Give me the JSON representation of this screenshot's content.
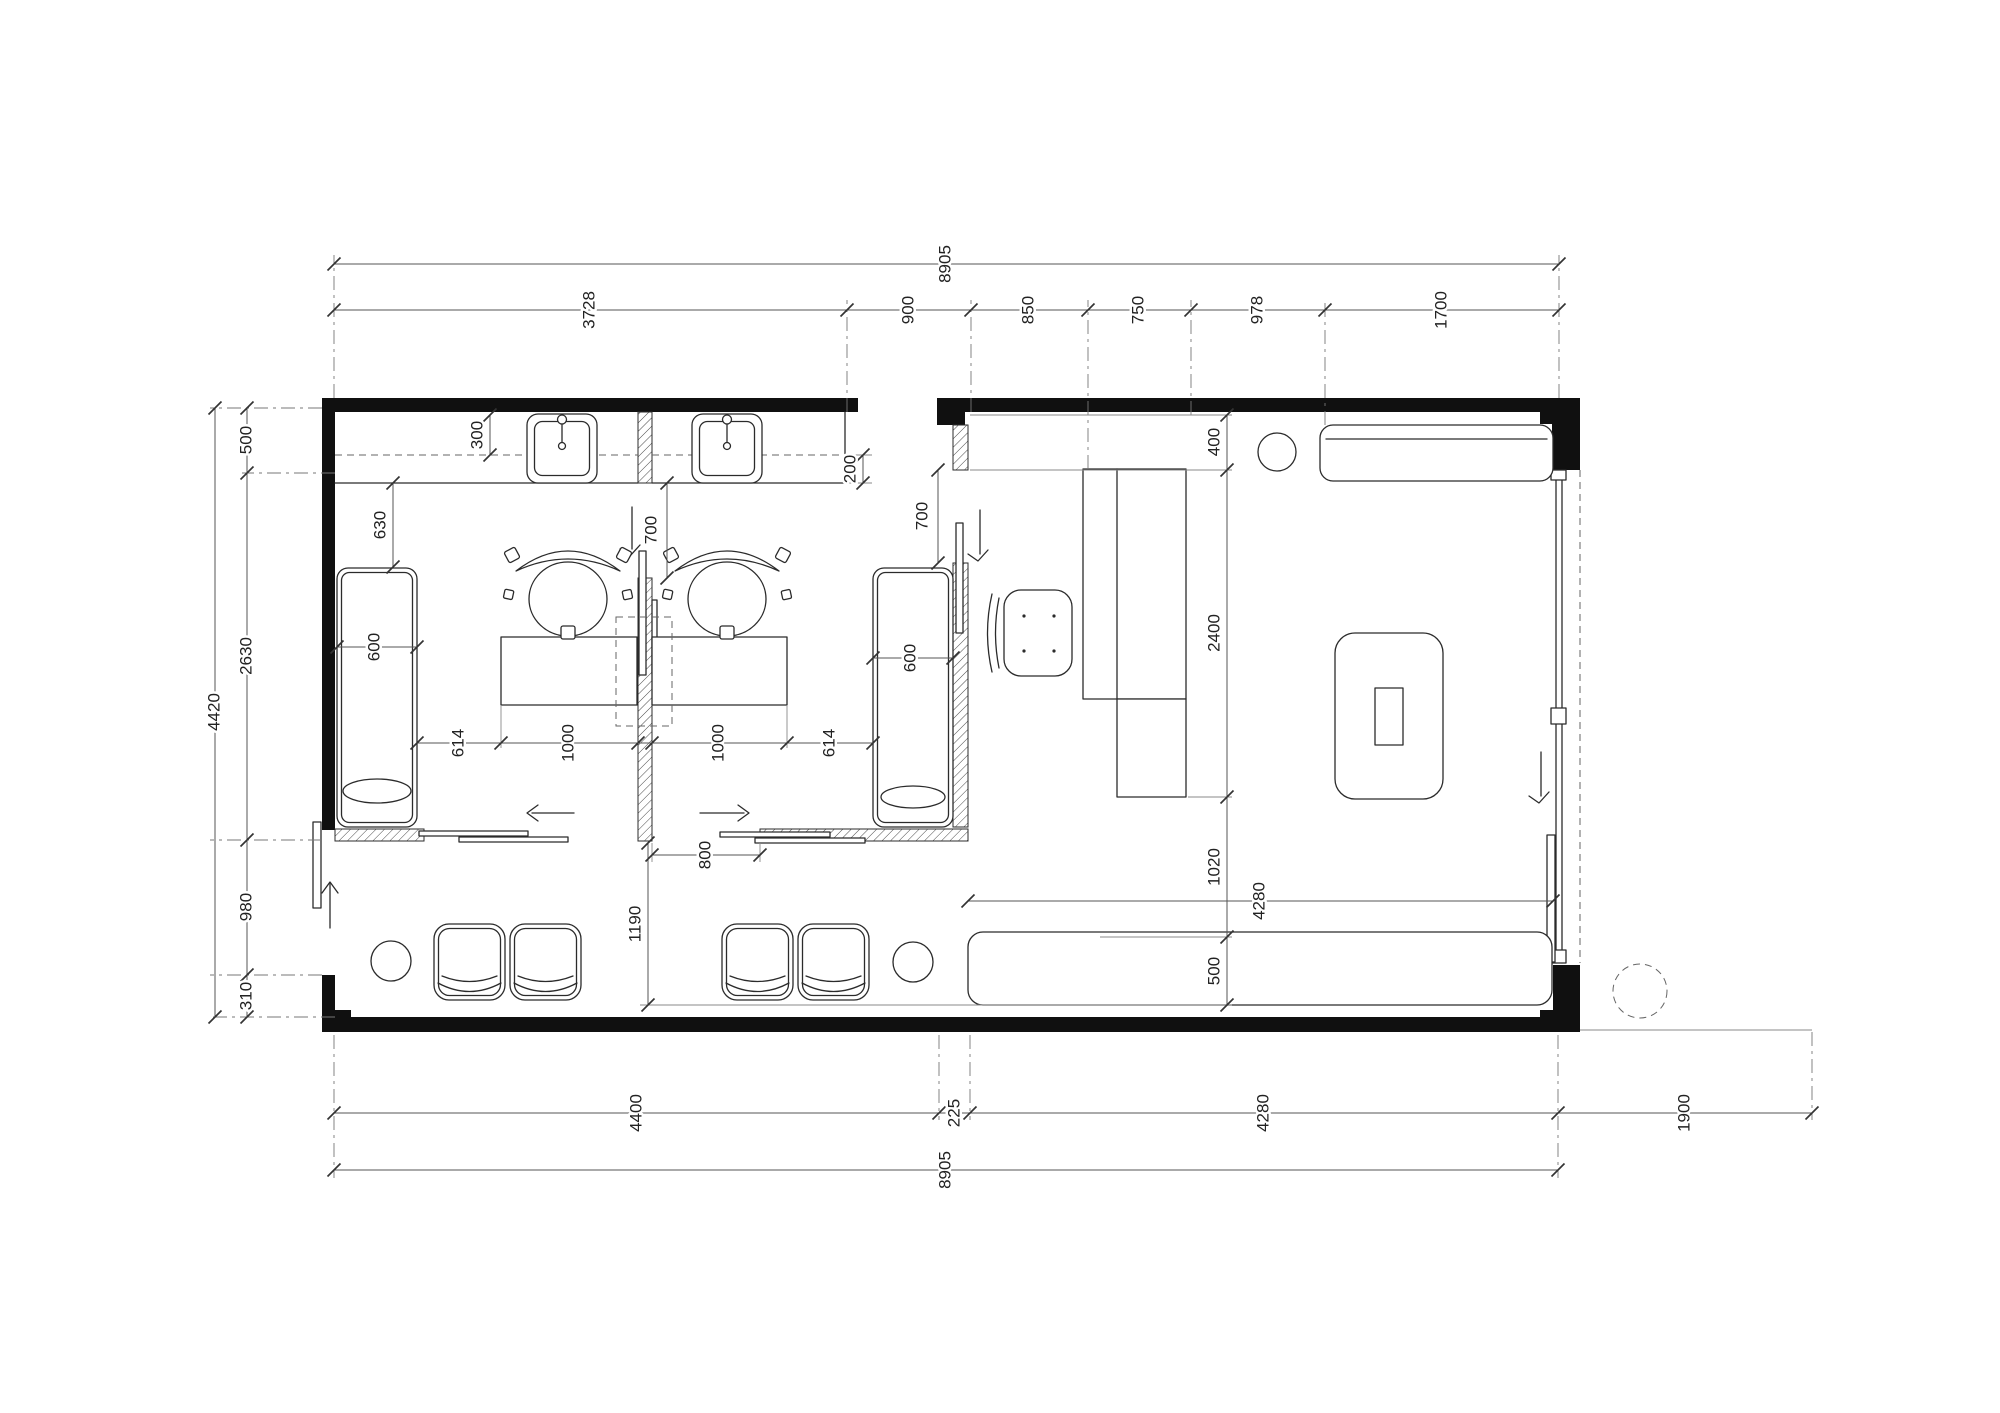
{
  "drawing": {
    "colors": {
      "background": "#ffffff",
      "wall_fill": "#101010",
      "furniture_line": "#2b2b2b",
      "dimension_line": "#555555",
      "text": "#222222"
    }
  },
  "dimensions": {
    "top": {
      "overall": "8905",
      "segments": [
        "3728",
        "900",
        "850",
        "750",
        "978",
        "1700"
      ]
    },
    "bottom": {
      "segments": [
        "4400",
        "225",
        "4280"
      ],
      "overall": "8905",
      "right_offset": "1900"
    },
    "left": {
      "overall": "4420",
      "segments": [
        "500",
        "2630",
        "980",
        "310"
      ]
    },
    "right_interior": {
      "segments": [
        "400",
        "2400",
        "1020",
        "500"
      ],
      "lounge_width": "4280"
    },
    "interior": {
      "counter_depth": "300",
      "counter_overhang": "200",
      "bench_setback": "630",
      "bench_width_left": "600",
      "bench_width_right": "600",
      "partition_door_left": "700",
      "partition_door_right": "700",
      "styling_chain": [
        "614",
        "1000",
        "1000",
        "614"
      ],
      "sliding_door_opening": "800",
      "waiting_aisle": "1190"
    }
  }
}
